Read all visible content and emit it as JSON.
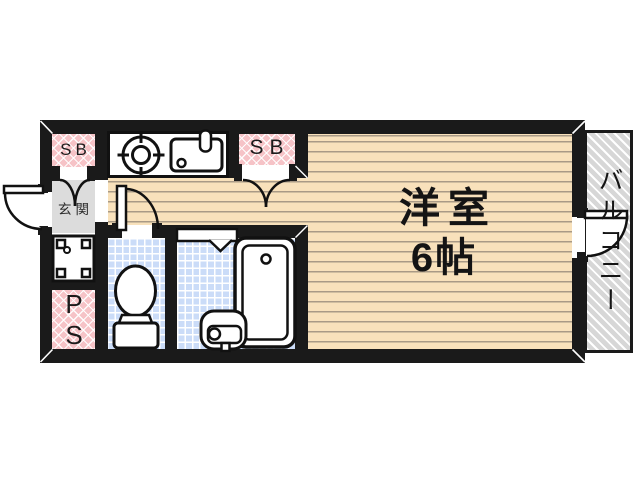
{
  "plan": {
    "rooms": {
      "sb_top_left": {
        "label": "SB"
      },
      "sb_middle": {
        "label": "SB"
      },
      "genkan": {
        "label": "玄関"
      },
      "ps": {
        "label": "PS"
      },
      "main_room": {
        "name": "洋室",
        "size": "6帖"
      },
      "balcony": {
        "label": "バルコニー"
      }
    },
    "fixtures": [
      "gas-stove-icon",
      "kitchen-sink-icon",
      "toilet-icon",
      "bathtub-icon",
      "bath-washbasin-icon",
      "laundry-pan-icon",
      "entrance-door-icon",
      "toilet-door-icon",
      "balcony-door-icon",
      "closet-double-doors-icon",
      "bath-folding-door-icon"
    ],
    "colors": {
      "wall": "#1a1a1a",
      "flooring": "#f8e1bb",
      "flooring_line": "#a99a86",
      "closet_pink": "#f6c3c7",
      "tile_blue": "#cbdcf8",
      "genkan_gray": "#dcdcdc",
      "balcony_gray": "#d7d7d7",
      "fixture_white": "#ffffff",
      "line_black": "#111111"
    }
  }
}
